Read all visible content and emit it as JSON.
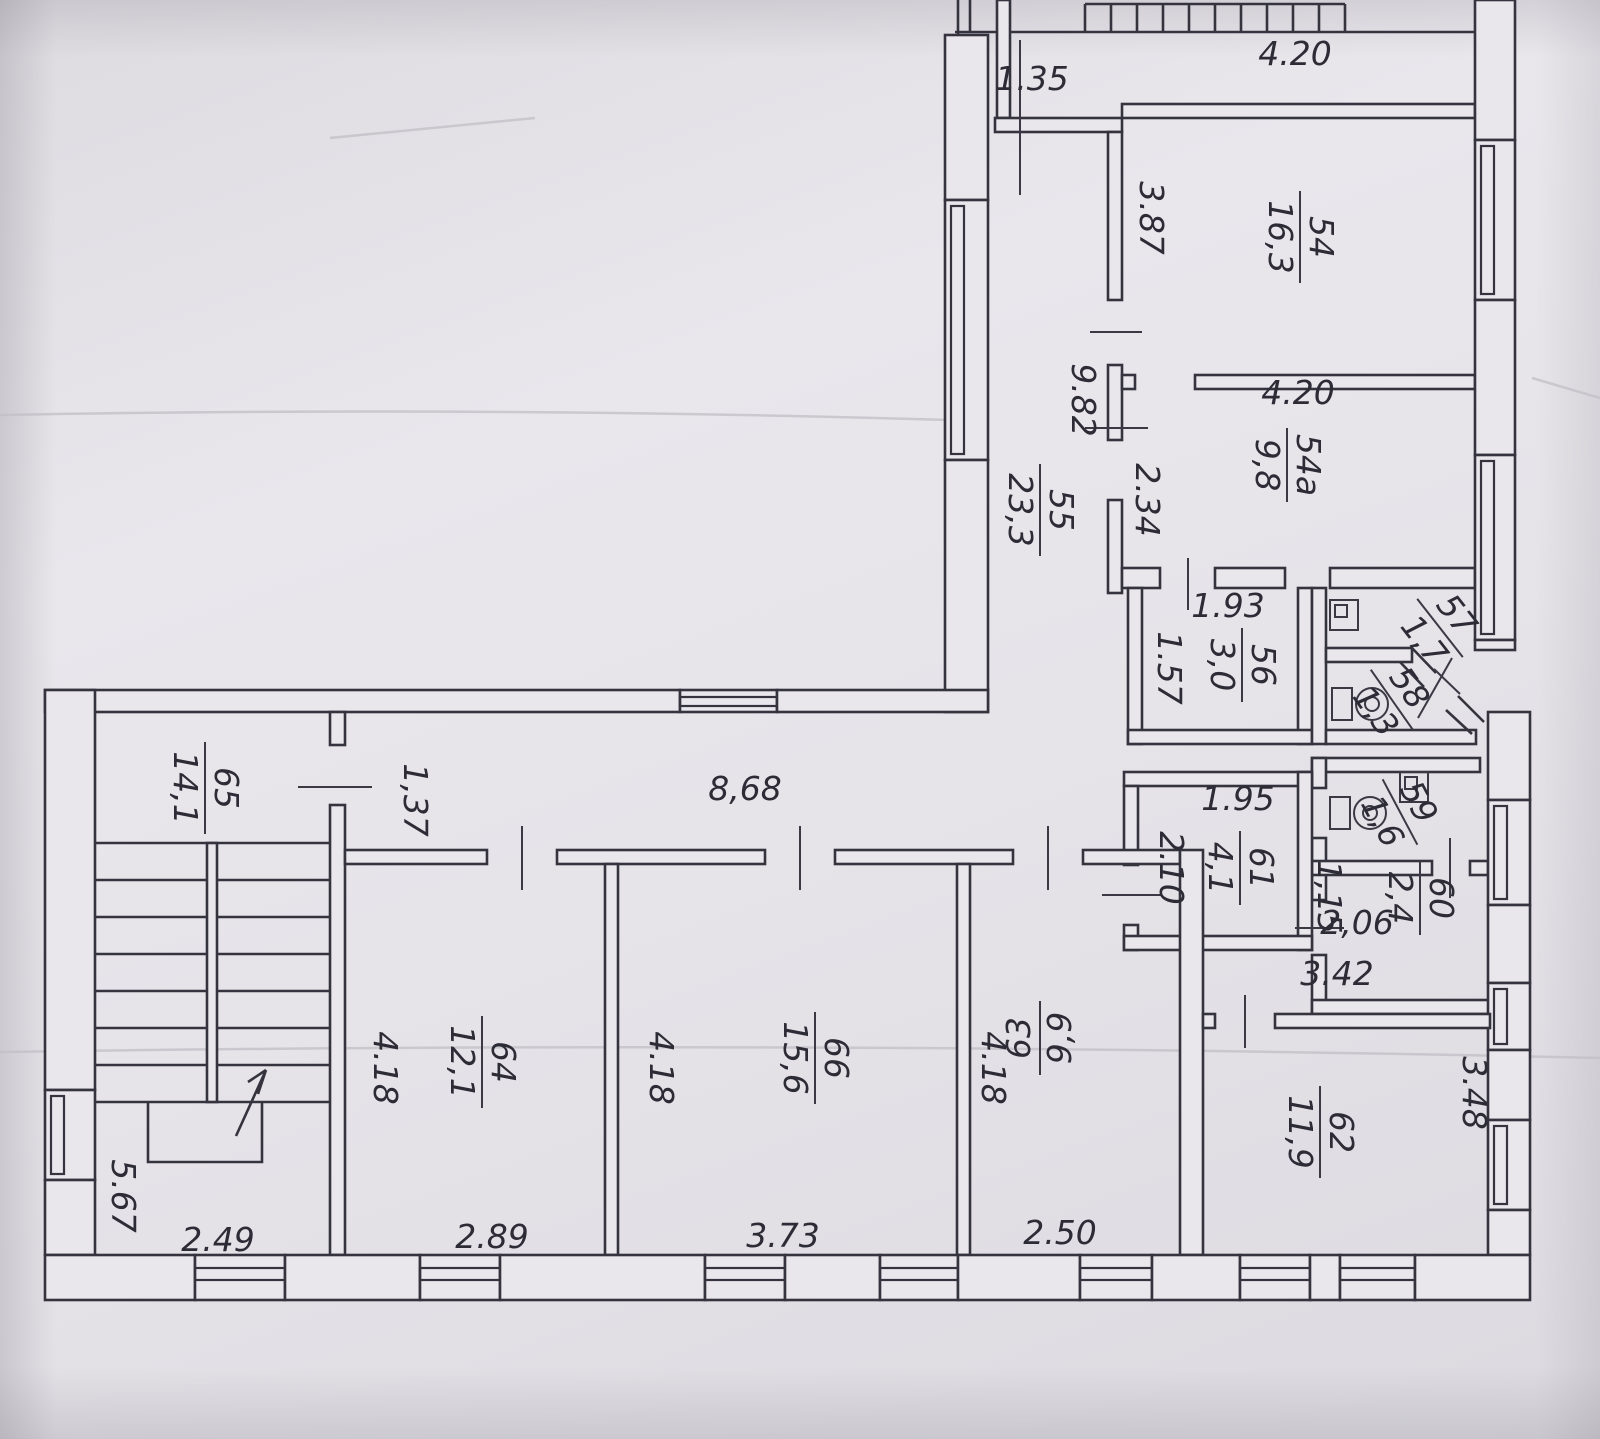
{
  "drawing": {
    "kind": "scanned floor plan",
    "ink_color": "#35343e",
    "paper_color": "#e9e7ec"
  },
  "rooms": [
    {
      "number": "54",
      "area": "16,3",
      "x": 1300,
      "y": 237,
      "rot": 90
    },
    {
      "number": "54a",
      "area": "9,8",
      "x": 1287,
      "y": 465,
      "rot": 90
    },
    {
      "number": "55",
      "area": "23,3",
      "x": 1040,
      "y": 510,
      "rot": 90
    },
    {
      "number": "56",
      "area": "3,0",
      "x": 1242,
      "y": 665,
      "rot": 90
    },
    {
      "number": "57",
      "area": "1,7",
      "x": 1440,
      "y": 628,
      "rot": 52
    },
    {
      "number": "58",
      "area": "1,3",
      "x": 1392,
      "y": 700,
      "rot": 55
    },
    {
      "number": "59",
      "area": "1,6",
      "x": 1400,
      "y": 812,
      "rot": 62
    },
    {
      "number": "60",
      "area": "2,4",
      "x": 1420,
      "y": 898,
      "rot": 90
    },
    {
      "number": "61",
      "area": "4,1",
      "x": 1240,
      "y": 868,
      "rot": 90
    },
    {
      "number": "62",
      "area": "11,9",
      "x": 1320,
      "y": 1132,
      "rot": 90
    },
    {
      "number": "63",
      "area": "9,9",
      "x": 1040,
      "y": 1038,
      "rot": -90
    },
    {
      "number": "64",
      "area": "12,1",
      "x": 482,
      "y": 1062,
      "rot": 90
    },
    {
      "number": "65",
      "area": "14,1",
      "x": 205,
      "y": 788,
      "rot": 90
    },
    {
      "number": "66",
      "area": "15,6",
      "x": 815,
      "y": 1058,
      "rot": 90
    }
  ],
  "dimensions": [
    {
      "text": "4.20",
      "x": 1295,
      "y": 65,
      "rot": 0
    },
    {
      "text": "1.35",
      "x": 1032,
      "y": 90,
      "rot": 0
    },
    {
      "text": "3.87",
      "x": 1140,
      "y": 218,
      "rot": 90
    },
    {
      "text": "9.82",
      "x": 1072,
      "y": 400,
      "rot": 90
    },
    {
      "text": "4.20",
      "x": 1298,
      "y": 404,
      "rot": 0
    },
    {
      "text": "2.34",
      "x": 1136,
      "y": 500,
      "rot": 90
    },
    {
      "text": "1.93",
      "x": 1228,
      "y": 617,
      "rot": 0
    },
    {
      "text": "1.57",
      "x": 1158,
      "y": 668,
      "rot": 90
    },
    {
      "text": "1.95",
      "x": 1238,
      "y": 810,
      "rot": 0
    },
    {
      "text": "2.10",
      "x": 1160,
      "y": 868,
      "rot": 90
    },
    {
      "text": "1,15",
      "x": 1318,
      "y": 897,
      "rot": 90
    },
    {
      "text": "2,06",
      "x": 1357,
      "y": 934,
      "rot": 0
    },
    {
      "text": "3.42",
      "x": 1337,
      "y": 985,
      "rot": 0
    },
    {
      "text": "3.48",
      "x": 1463,
      "y": 1093,
      "rot": 90
    },
    {
      "text": "8,68",
      "x": 745,
      "y": 800,
      "rot": 0
    },
    {
      "text": "1,37",
      "x": 404,
      "y": 800,
      "rot": 90
    },
    {
      "text": "4.18",
      "x": 374,
      "y": 1068,
      "rot": 90
    },
    {
      "text": "2.89",
      "x": 492,
      "y": 1248,
      "rot": 0
    },
    {
      "text": "4.18",
      "x": 650,
      "y": 1068,
      "rot": 90
    },
    {
      "text": "3.73",
      "x": 783,
      "y": 1247,
      "rot": 0
    },
    {
      "text": "4.18",
      "x": 982,
      "y": 1068,
      "rot": 90
    },
    {
      "text": "2.50",
      "x": 1060,
      "y": 1244,
      "rot": 0
    },
    {
      "text": "5.67",
      "x": 112,
      "y": 1196,
      "rot": 90
    },
    {
      "text": "2.49",
      "x": 218,
      "y": 1251,
      "rot": 0
    }
  ],
  "icons": [
    {
      "type": "toilet",
      "name": "toilet-icon-room58",
      "x": 1332,
      "y": 688
    },
    {
      "type": "toilet",
      "name": "toilet-icon-room59",
      "x": 1330,
      "y": 797
    },
    {
      "type": "sink",
      "name": "sink-icon-room57",
      "x": 1330,
      "y": 600
    },
    {
      "type": "sink",
      "name": "sink-icon-room59",
      "x": 1400,
      "y": 772
    },
    {
      "type": "up-arrow",
      "name": "stairs-direction-arrow",
      "x1": 236,
      "y1": 1136,
      "x2": 266,
      "y2": 1070
    }
  ]
}
